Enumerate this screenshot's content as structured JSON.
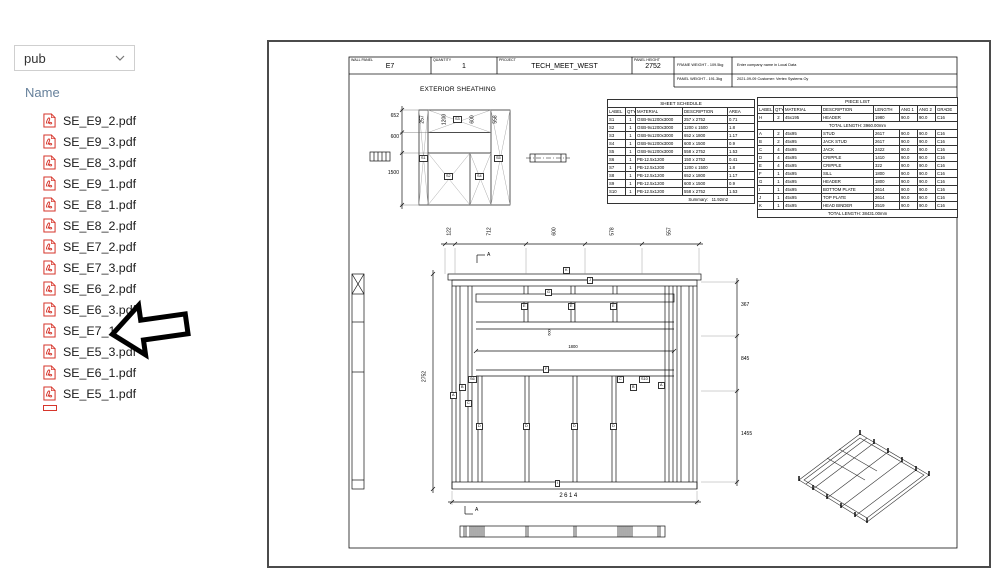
{
  "colors": {
    "pdf_icon": "#d6352b",
    "arrow_annotation": "#000000",
    "viewer_border": "#4b4b4b",
    "name_header_text": "#66809b"
  },
  "icons": {
    "file_icon": "pdf-file-icon",
    "dropdown_icon": "chevron-down-icon",
    "annotation": "left-arrow-annotation"
  },
  "file_browser": {
    "folder_dropdown_value": "pub",
    "name_column_header": "Name",
    "arrow_target_file": "SE_E7_1.pdf",
    "files": [
      "SE_E9_2.pdf",
      "SE_E9_3.pdf",
      "SE_E8_3.pdf",
      "SE_E9_1.pdf",
      "SE_E8_1.pdf",
      "SE_E8_2.pdf",
      "SE_E7_2.pdf",
      "SE_E7_3.pdf",
      "SE_E6_2.pdf",
      "SE_E6_3.pdf",
      "SE_E7_1.pdf",
      "SE_E5_3.pdf",
      "SE_E6_1.pdf",
      "SE_E5_1.pdf"
    ]
  },
  "viewer": {
    "title_block": {
      "wall_panel_label": "WALL PANEL",
      "wall_panel_value": "E7",
      "quantity_label": "QUANTITY",
      "quantity_value": "1",
      "project_label": "PROJECT",
      "project_value": "TECH_MEET_WEST",
      "panel_height_label": "PANEL HEIGHT",
      "panel_height_value": "2752",
      "frame_weight": "FRAME WEIGHT - 109.5kg",
      "panel_weight": "PANEL WEIGHT - 191.3kg",
      "company_line1": "Enter company name in Local Data",
      "company_line2": "2021-09-09   Customer: Vertex Systems Oy"
    },
    "sheathing": {
      "title": "EXTERIOR SHEATHING",
      "left_dims": [
        "652",
        "600",
        "1500"
      ],
      "top_dims": [
        "257",
        "1200",
        "600",
        "558"
      ],
      "labels": [
        "S1",
        "S3",
        "S2",
        "S4",
        "S5"
      ]
    },
    "sheet_schedule": {
      "title": "SHEET SCHEDULE",
      "headers": [
        "LABEL",
        "QTY",
        "MATERIAL",
        "DESCRIPTION",
        "AREA"
      ],
      "rows": [
        [
          "S1",
          "1",
          "OSB-9x1200x3000",
          "257 x 2752",
          "0.71"
        ],
        [
          "S2",
          "1",
          "OSB-9x1200x3000",
          "1200 x 1500",
          "1.8"
        ],
        [
          "S3",
          "1",
          "OSB-9x1200x3000",
          "652 x 1800",
          "1.17"
        ],
        [
          "S4",
          "1",
          "OSB-9x1200x3000",
          "600 x 1500",
          "0.9"
        ],
        [
          "S5",
          "1",
          "OSB-9x1200x3000",
          "558 x 2752",
          "1.53"
        ],
        [
          "S6",
          "1",
          "PB-12.5x1200",
          "150 x 2752",
          "0.41"
        ],
        [
          "S7",
          "1",
          "PB-12.5x1200",
          "1200 x 1500",
          "1.8"
        ],
        [
          "S8",
          "1",
          "PB-12.5x1200",
          "652 x 1800",
          "1.17"
        ],
        [
          "S9",
          "1",
          "PB-12.5x1200",
          "600 x 1500",
          "0.9"
        ],
        [
          "S10",
          "1",
          "PB-12.5x1200",
          "558 x 2752",
          "1.53"
        ]
      ],
      "summary_label": "Summary:",
      "summary_value": "11.92m2"
    },
    "piece_list": {
      "title": "PIECE LIST",
      "headers": [
        "LABEL",
        "QTY",
        "MATERIAL",
        "DESCRIPTION",
        "LENGTH",
        "ANG 1",
        "ANG 2",
        "GRADE"
      ],
      "top_rows": [
        [
          "H",
          "2",
          "45x195",
          "HEADER",
          "1980",
          "90.0",
          "90.0",
          "C16"
        ]
      ],
      "subtotal": "TOTAL LENGTH:  3960.00mm",
      "rows": [
        [
          "A",
          "2",
          "45x95",
          "STUD",
          "2617",
          "90.0",
          "90.0",
          "C16"
        ],
        [
          "B",
          "2",
          "45x95",
          "JACK STUD",
          "2617",
          "90.0",
          "90.0",
          "C16"
        ],
        [
          "C",
          "4",
          "45x95",
          "JACK",
          "2422",
          "90.0",
          "90.0",
          "C16"
        ],
        [
          "D",
          "4",
          "45x95",
          "CRIPPLE",
          "1410",
          "90.0",
          "90.0",
          "C16"
        ],
        [
          "E",
          "4",
          "45x95",
          "CRIPPLE",
          "322",
          "90.0",
          "90.0",
          "C16"
        ],
        [
          "F",
          "1",
          "45x95",
          "SILL",
          "1800",
          "90.0",
          "90.0",
          "C16"
        ],
        [
          "G",
          "1",
          "45x95",
          "HEADER",
          "1800",
          "90.0",
          "90.0",
          "C16"
        ],
        [
          "I",
          "1",
          "45x95",
          "BOTTOM PLATE",
          "2614",
          "90.0",
          "90.0",
          "C16"
        ],
        [
          "J",
          "1",
          "45x95",
          "TOP PLATE",
          "2614",
          "90.0",
          "90.0",
          "C16"
        ],
        [
          "K",
          "1",
          "45x95",
          "HEAD BINDER",
          "2519",
          "90.0",
          "90.0",
          "C16"
        ]
      ],
      "total": "TOTAL LENGTH: 38431.00mm"
    },
    "elevation": {
      "top_dims": [
        "122",
        "712",
        "600",
        "578",
        "557"
      ],
      "left_dim": "2752",
      "right_dims": [
        "367",
        "845",
        "1455"
      ],
      "bottom_dim": "2614",
      "inner_width_dim": "1800",
      "inner_height_dim": "600",
      "section_mark": "A",
      "tags": [
        "K",
        "J",
        "G",
        "E",
        "E",
        "E",
        "F",
        "S6",
        "B",
        "A",
        "C",
        "D",
        "D",
        "D",
        "D",
        "C",
        "B",
        "S10",
        "A",
        "I"
      ]
    }
  }
}
